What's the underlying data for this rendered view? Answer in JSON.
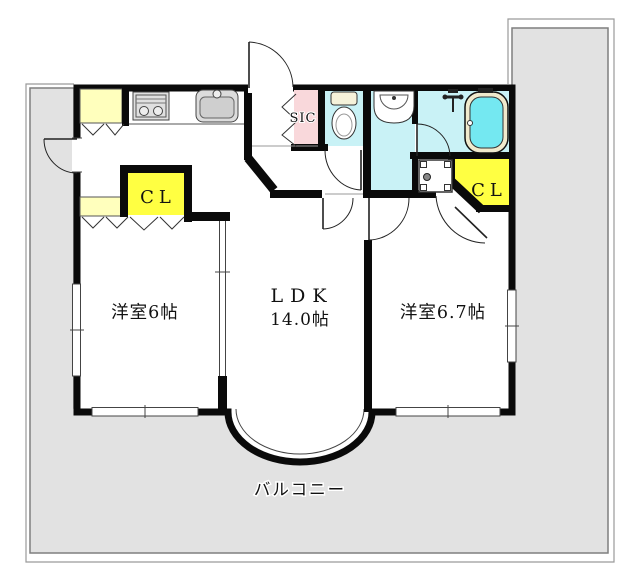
{
  "floorplan": {
    "labels": {
      "room_left": "洋室6帖",
      "ldk": "LDK",
      "ldk_size": "14.0帖",
      "room_right": "洋室6.7帖",
      "balcony": "バルコニー",
      "closet_left": "CL",
      "closet_right": "CL",
      "sic": "SIC"
    },
    "colors": {
      "wall": "#0a0a0a",
      "balcony_fill": "#e2e2e2",
      "wet_area_fill": "#c9f2f6",
      "closet_fill": "#ffff42",
      "cabinet_fill": "#ffffbd",
      "sic_fill": "#f9d8db",
      "tub_water": "#74e8f1",
      "tub_rim": "#f0eacd",
      "toilet_tank": "#f5f2da"
    }
  }
}
